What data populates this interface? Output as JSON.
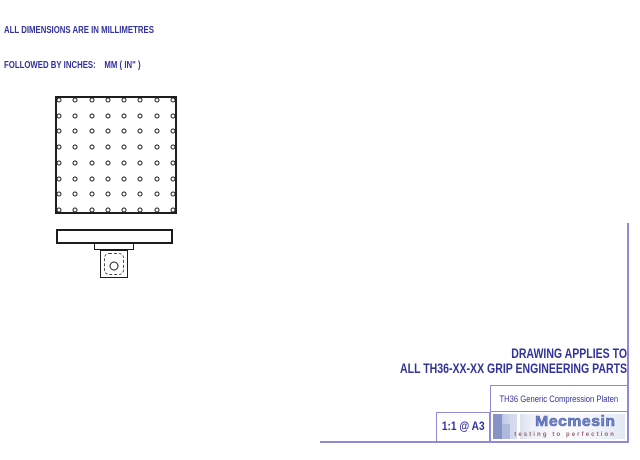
{
  "sheet": {
    "units_note": {
      "line1": "ALL DIMENSIONS ARE IN MILLIMETRES",
      "line2": "FOLLOWED BY INCHES:    MM ( IN\" )"
    },
    "applies_note": {
      "line1": "DRAWING APPLIES TO",
      "line2": "ALL TH36-XX-XX GRIP ENGINEERING PARTS"
    }
  },
  "drawing": {
    "top_view": {
      "hole_rows": 8,
      "hole_cols": 8
    }
  },
  "title_block": {
    "part_title": "TH36 Generic Compression Platen",
    "scale": "1:1 @ A3",
    "brand": "Mecmesin",
    "tagline": "testing to perfection"
  },
  "colors": {
    "ink": "#32329b",
    "frame": "#9288d8",
    "line": "#1c1c1c",
    "brand_blue": "#7287cc",
    "tagline_red": "#9c6066"
  }
}
